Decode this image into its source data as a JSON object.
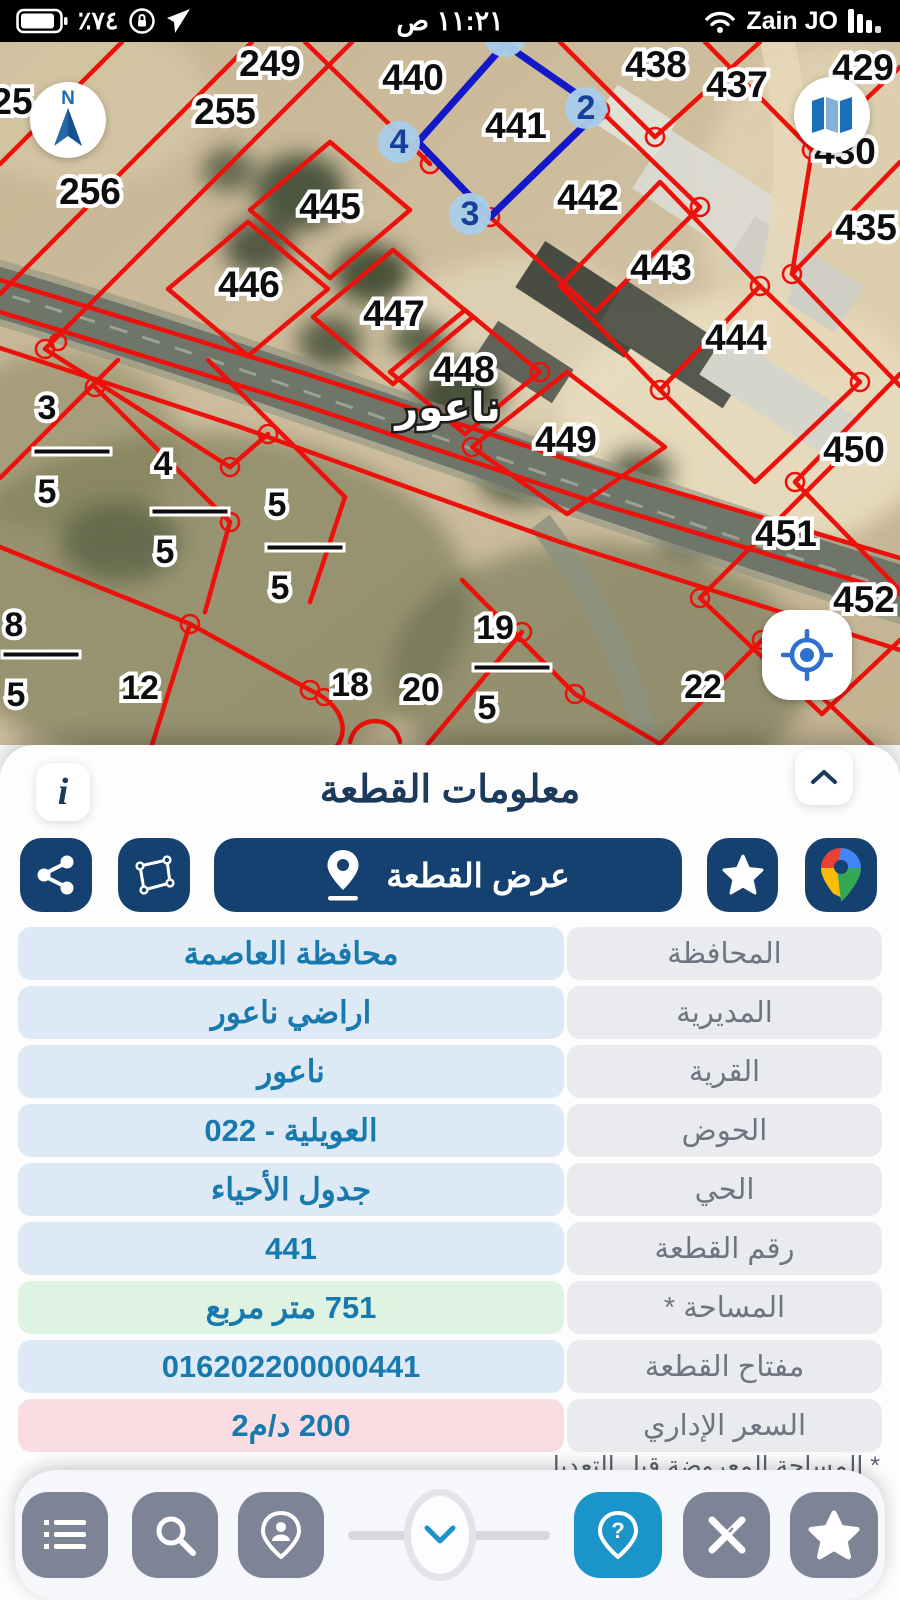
{
  "status_bar": {
    "battery_percent": "٧٤٪",
    "time": "١١:٢١ ص",
    "carrier": "Zain JO"
  },
  "map": {
    "locality_label": {
      "t": "ناعور",
      "x": 448,
      "y": 368
    },
    "parcel_labels": [
      {
        "t": "249",
        "x": 270,
        "y": 24
      },
      {
        "t": "255",
        "x": 225,
        "y": 72
      },
      {
        "t": "25",
        "x": 12,
        "y": 62
      },
      {
        "t": "256",
        "x": 90,
        "y": 152
      },
      {
        "t": "440",
        "x": 413,
        "y": 38
      },
      {
        "t": "441",
        "x": 516,
        "y": 86
      },
      {
        "t": "438",
        "x": 656,
        "y": 25
      },
      {
        "t": "437",
        "x": 737,
        "y": 45
      },
      {
        "t": "429",
        "x": 863,
        "y": 28
      },
      {
        "t": "430",
        "x": 845,
        "y": 112
      },
      {
        "t": "435",
        "x": 866,
        "y": 188
      },
      {
        "t": "442",
        "x": 588,
        "y": 158
      },
      {
        "t": "443",
        "x": 661,
        "y": 228
      },
      {
        "t": "444",
        "x": 736,
        "y": 298
      },
      {
        "t": "445",
        "x": 330,
        "y": 167
      },
      {
        "t": "446",
        "x": 249,
        "y": 245
      },
      {
        "t": "447",
        "x": 394,
        "y": 274
      },
      {
        "t": "448",
        "x": 464,
        "y": 330
      },
      {
        "t": "449",
        "x": 566,
        "y": 400
      },
      {
        "t": "450",
        "x": 854,
        "y": 410
      },
      {
        "t": "451",
        "x": 786,
        "y": 494
      },
      {
        "t": "452",
        "x": 864,
        "y": 560
      }
    ],
    "small_labels": [
      {
        "t": "3",
        "x": 47,
        "y": 368
      },
      {
        "t": "4",
        "x": 163,
        "y": 424
      },
      {
        "t": "5",
        "x": 277,
        "y": 465
      },
      {
        "t": "8",
        "x": 14,
        "y": 585
      },
      {
        "t": "12",
        "x": 140,
        "y": 648
      },
      {
        "t": "18",
        "x": 350,
        "y": 645
      },
      {
        "t": "19",
        "x": 495,
        "y": 588
      },
      {
        "t": "20",
        "x": 421,
        "y": 650
      },
      {
        "t": "22",
        "x": 703,
        "y": 647
      }
    ],
    "fraction_label": "5",
    "fractions": [
      {
        "x": 47,
        "y": 452
      },
      {
        "x": 165,
        "y": 512
      },
      {
        "x": 280,
        "y": 548
      },
      {
        "x": 16,
        "y": 655
      },
      {
        "x": 487,
        "y": 668
      }
    ],
    "corner_markers": [
      {
        "n": "2",
        "x": 586,
        "y": 66
      },
      {
        "n": "3",
        "x": 470,
        "y": 172
      },
      {
        "n": "4",
        "x": 399,
        "y": 100
      },
      {
        "n": "",
        "x": 505,
        "y": -6
      }
    ]
  },
  "sheet": {
    "title": "معلومات القطعة",
    "info_button": "i",
    "view_button": "عرض القطعة",
    "rows": [
      {
        "label": "المحافظة",
        "value": "محافظة العاصمة",
        "tone": "blue"
      },
      {
        "label": "المديرية",
        "value": "اراضي ناعور",
        "tone": "blue"
      },
      {
        "label": "القرية",
        "value": "ناعور",
        "tone": "blue"
      },
      {
        "label": "الحوض",
        "value": "العويلية - 022",
        "tone": "blue"
      },
      {
        "label": "الحي",
        "value": "جدول الأحياء",
        "tone": "blue"
      },
      {
        "label": "رقم القطعة",
        "value": "441",
        "tone": "blue"
      },
      {
        "label": "المساحة *",
        "value": "751 متر مربع",
        "tone": "green"
      },
      {
        "label": "مفتاح القطعة",
        "value": "016202200000441",
        "tone": "blue"
      },
      {
        "label": "السعر الإداري",
        "value": "200 د/م2",
        "tone": "pink"
      }
    ],
    "footnote": "* المساحة المعروضة قبل التعديل"
  },
  "colors": {
    "navy": "#14416f",
    "accent_blue": "#1b94c9",
    "value_blue": "#1879ae",
    "red_line": "#ee100a",
    "selected_parcel_blue": "#1318c9",
    "green_cell": "#def3e2",
    "pink_cell": "#fadde2"
  }
}
